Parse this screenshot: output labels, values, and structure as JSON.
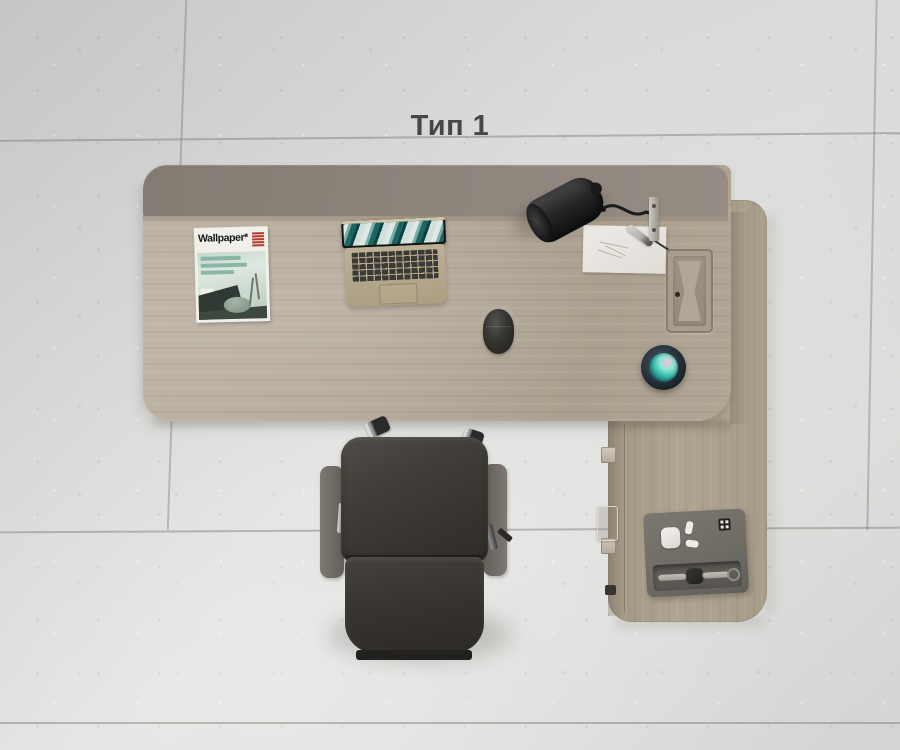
{
  "scene": {
    "title": "Тип 1",
    "colors": {
      "floor_concrete": "#dcdddb",
      "desk_wood": "#b5ab9b",
      "return_wood": "#aca18f",
      "back_panel": "#8d857c",
      "chair_leather": "#3b3835",
      "armrest_gray": "#6f6b66",
      "chrome": "#b5b5b5",
      "lamp_black": "#212121",
      "organizer_gray": "#6e6a64",
      "speaker_body": "#28313b",
      "speaker_glow_teal": "#45d6c1",
      "speaker_glow_pink": "#f2c3da",
      "laptop_gold": "#b2a78c",
      "magazine_red": "#b23a2c",
      "cover_teal": "#9dc3b3",
      "title_text": "#474747"
    }
  },
  "magazine": {
    "masthead": "Wallpaper*"
  }
}
